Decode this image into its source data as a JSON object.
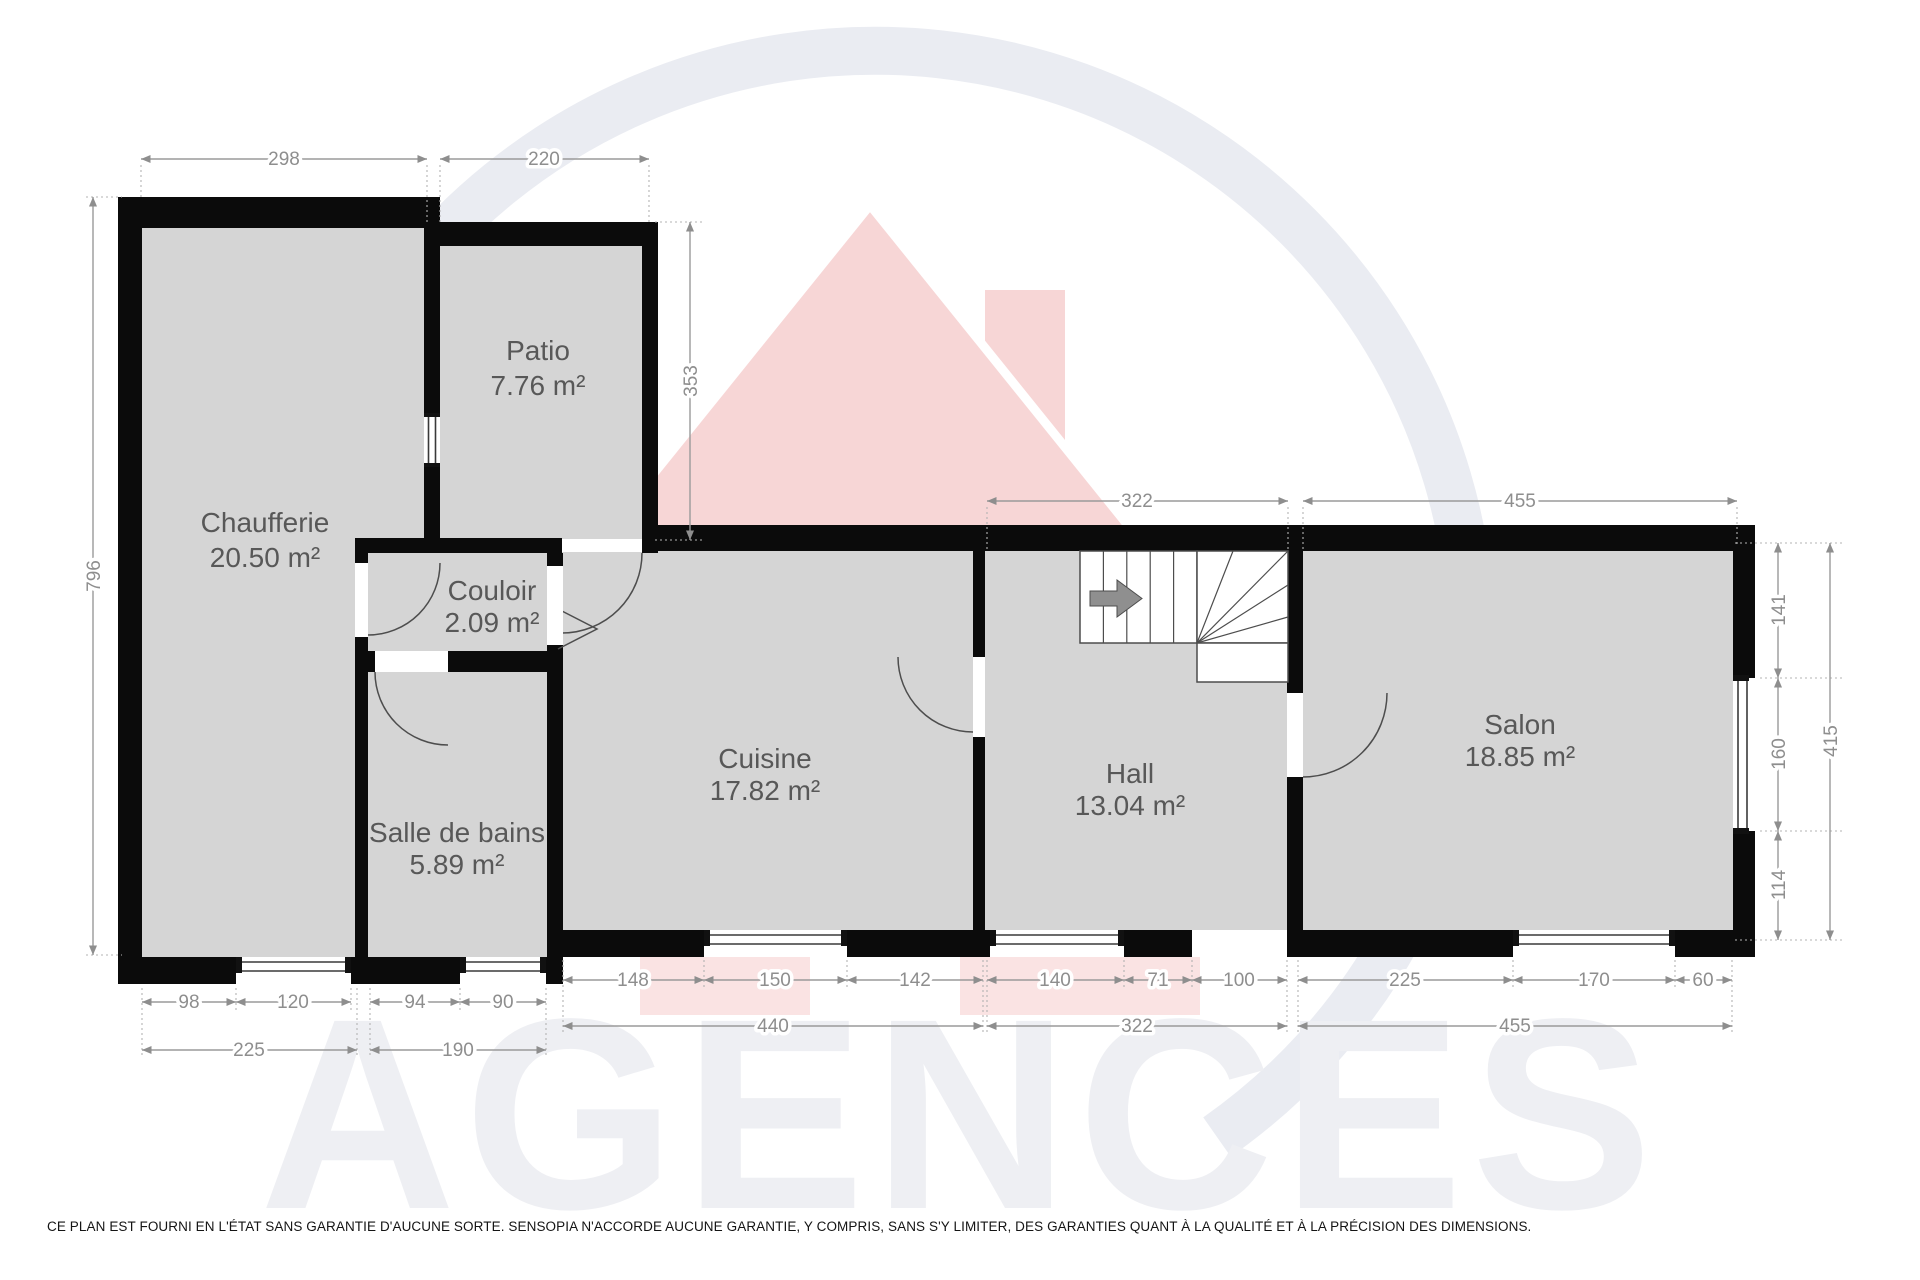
{
  "watermark": {
    "brand": "AGENCES"
  },
  "footer": {
    "disclaimer": "CE PLAN EST FOURNI EN L'ÉTAT SANS GARANTIE D'AUCUNE SORTE. SENSOPIA N'ACCORDE AUCUNE GARANTIE, Y COMPRIS, SANS S'Y LIMITER, DES GARANTIES QUANT À LA QUALITÉ ET À LA PRÉCISION DES DIMENSIONS."
  },
  "rooms": {
    "chaufferie": {
      "name": "Chaufferie",
      "area": "20.50 m²"
    },
    "patio": {
      "name": "Patio",
      "area": "7.76 m²"
    },
    "couloir": {
      "name": "Couloir",
      "area": "2.09 m²"
    },
    "cuisine": {
      "name": "Cuisine",
      "area": "17.82 m²"
    },
    "salle_de_bains": {
      "name": "Salle de bains",
      "area": "5.89 m²"
    },
    "hall": {
      "name": "Hall",
      "area": "13.04 m²"
    },
    "salon": {
      "name": "Salon",
      "area": "18.85 m²"
    }
  },
  "dimensions": {
    "top": {
      "chaufferie_width": "298",
      "patio_width": "220",
      "hall_width": "322",
      "salon_width": "455"
    },
    "left": {
      "total_height": "796"
    },
    "patio": {
      "height": "353"
    },
    "right": {
      "wall_upper": "141",
      "window": "160",
      "wall_lower": "114",
      "total": "415"
    },
    "bottom": {
      "chaufferie": {
        "segments": [
          "98",
          "120"
        ],
        "total": "225"
      },
      "salle_de_bains": {
        "segments": [
          "94",
          "90"
        ],
        "total": "190"
      },
      "cuisine": {
        "segments": [
          "148",
          "150",
          "142"
        ],
        "total": "440"
      },
      "hall": {
        "segments": [
          "140",
          "71",
          "100"
        ],
        "total": "322"
      },
      "salon": {
        "segments": [
          "225",
          "170",
          "60"
        ],
        "total": "455"
      }
    }
  }
}
